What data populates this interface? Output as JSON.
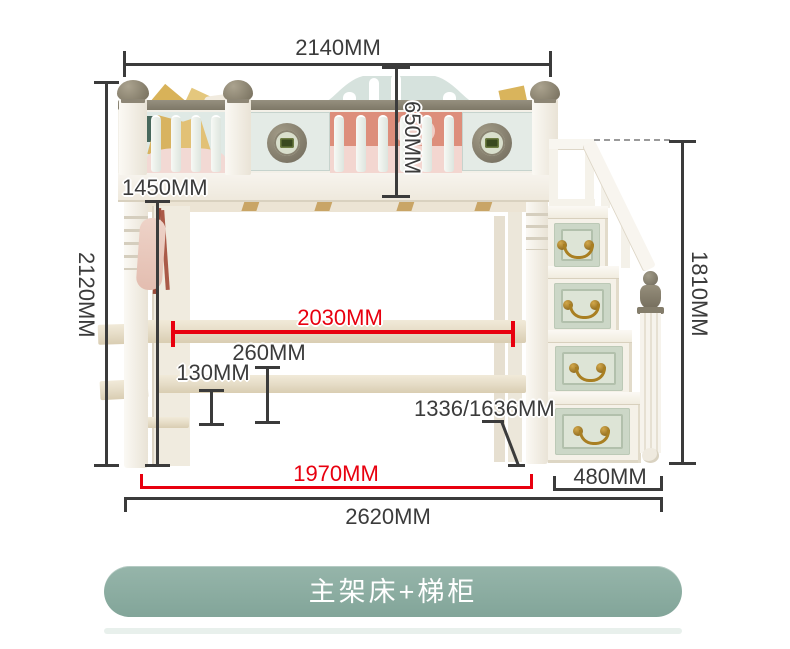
{
  "product": {
    "variant_label": "主架床+梯柜"
  },
  "dimensions": {
    "bed_length_top": "2140MM",
    "guardrail_height": "650MM",
    "under_bed_clearance": "1450MM",
    "overall_height": "2120MM",
    "stair_cabinet_height": "1810MM",
    "inner_length": "2030MM",
    "shelf_gap": "260MM",
    "beam_height": "130MM",
    "desk_height_options": "1336/1636MM",
    "floor_inner_length": "1970MM",
    "stair_cabinet_depth": "480MM",
    "overall_length": "2620MM"
  },
  "colors": {
    "dimension_line": "#3b3b3b",
    "highlight_red": "#e8000f",
    "variant_button": "#8cada2"
  }
}
